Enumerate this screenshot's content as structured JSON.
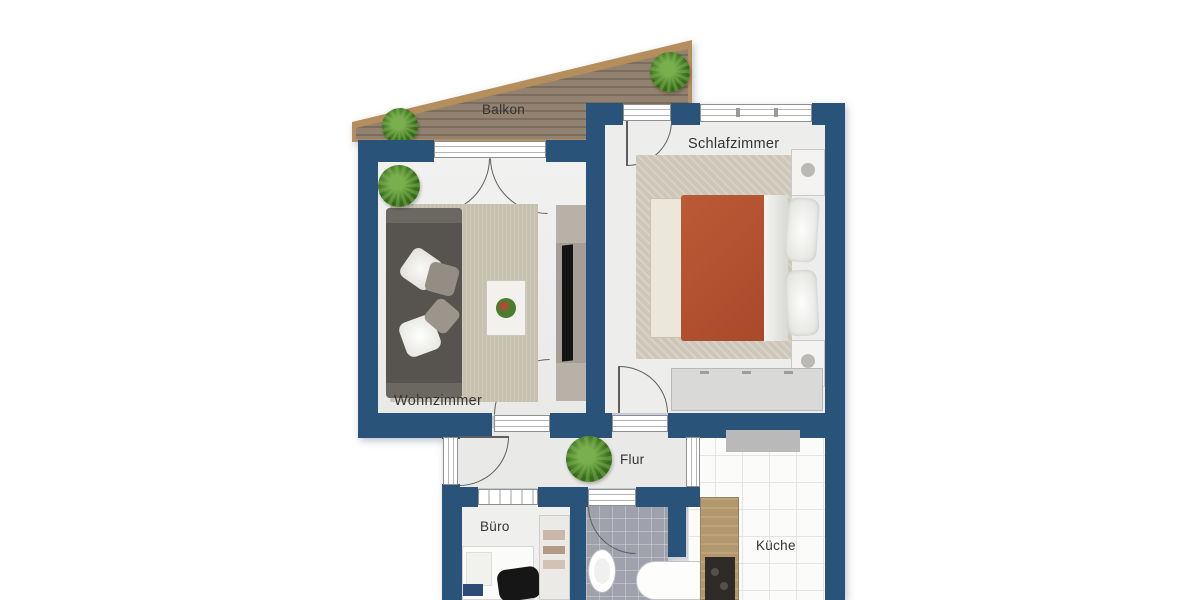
{
  "brand": {
    "name": "Immobilien",
    "tagline": "seit 1983",
    "navy": "#1e3c69"
  },
  "floorplan": {
    "labels": {
      "balkon": "Balkon",
      "schlafzimmer": "Schlafzimmer",
      "wohnzimmer": "Wohnzimmer",
      "flur": "Flur",
      "buero": "Büro",
      "kueche": "Küche"
    },
    "colors": {
      "wall": "#295379",
      "floor": "#ededec",
      "balcony_wood": "#92826f",
      "balcony_frame": "#b48e5c",
      "duvet": "#b1512f",
      "sofa": "#57544f",
      "rug": "#c6c0af",
      "bath_tile": "#9fa1ac",
      "counter_wood": "#b3976d"
    }
  }
}
